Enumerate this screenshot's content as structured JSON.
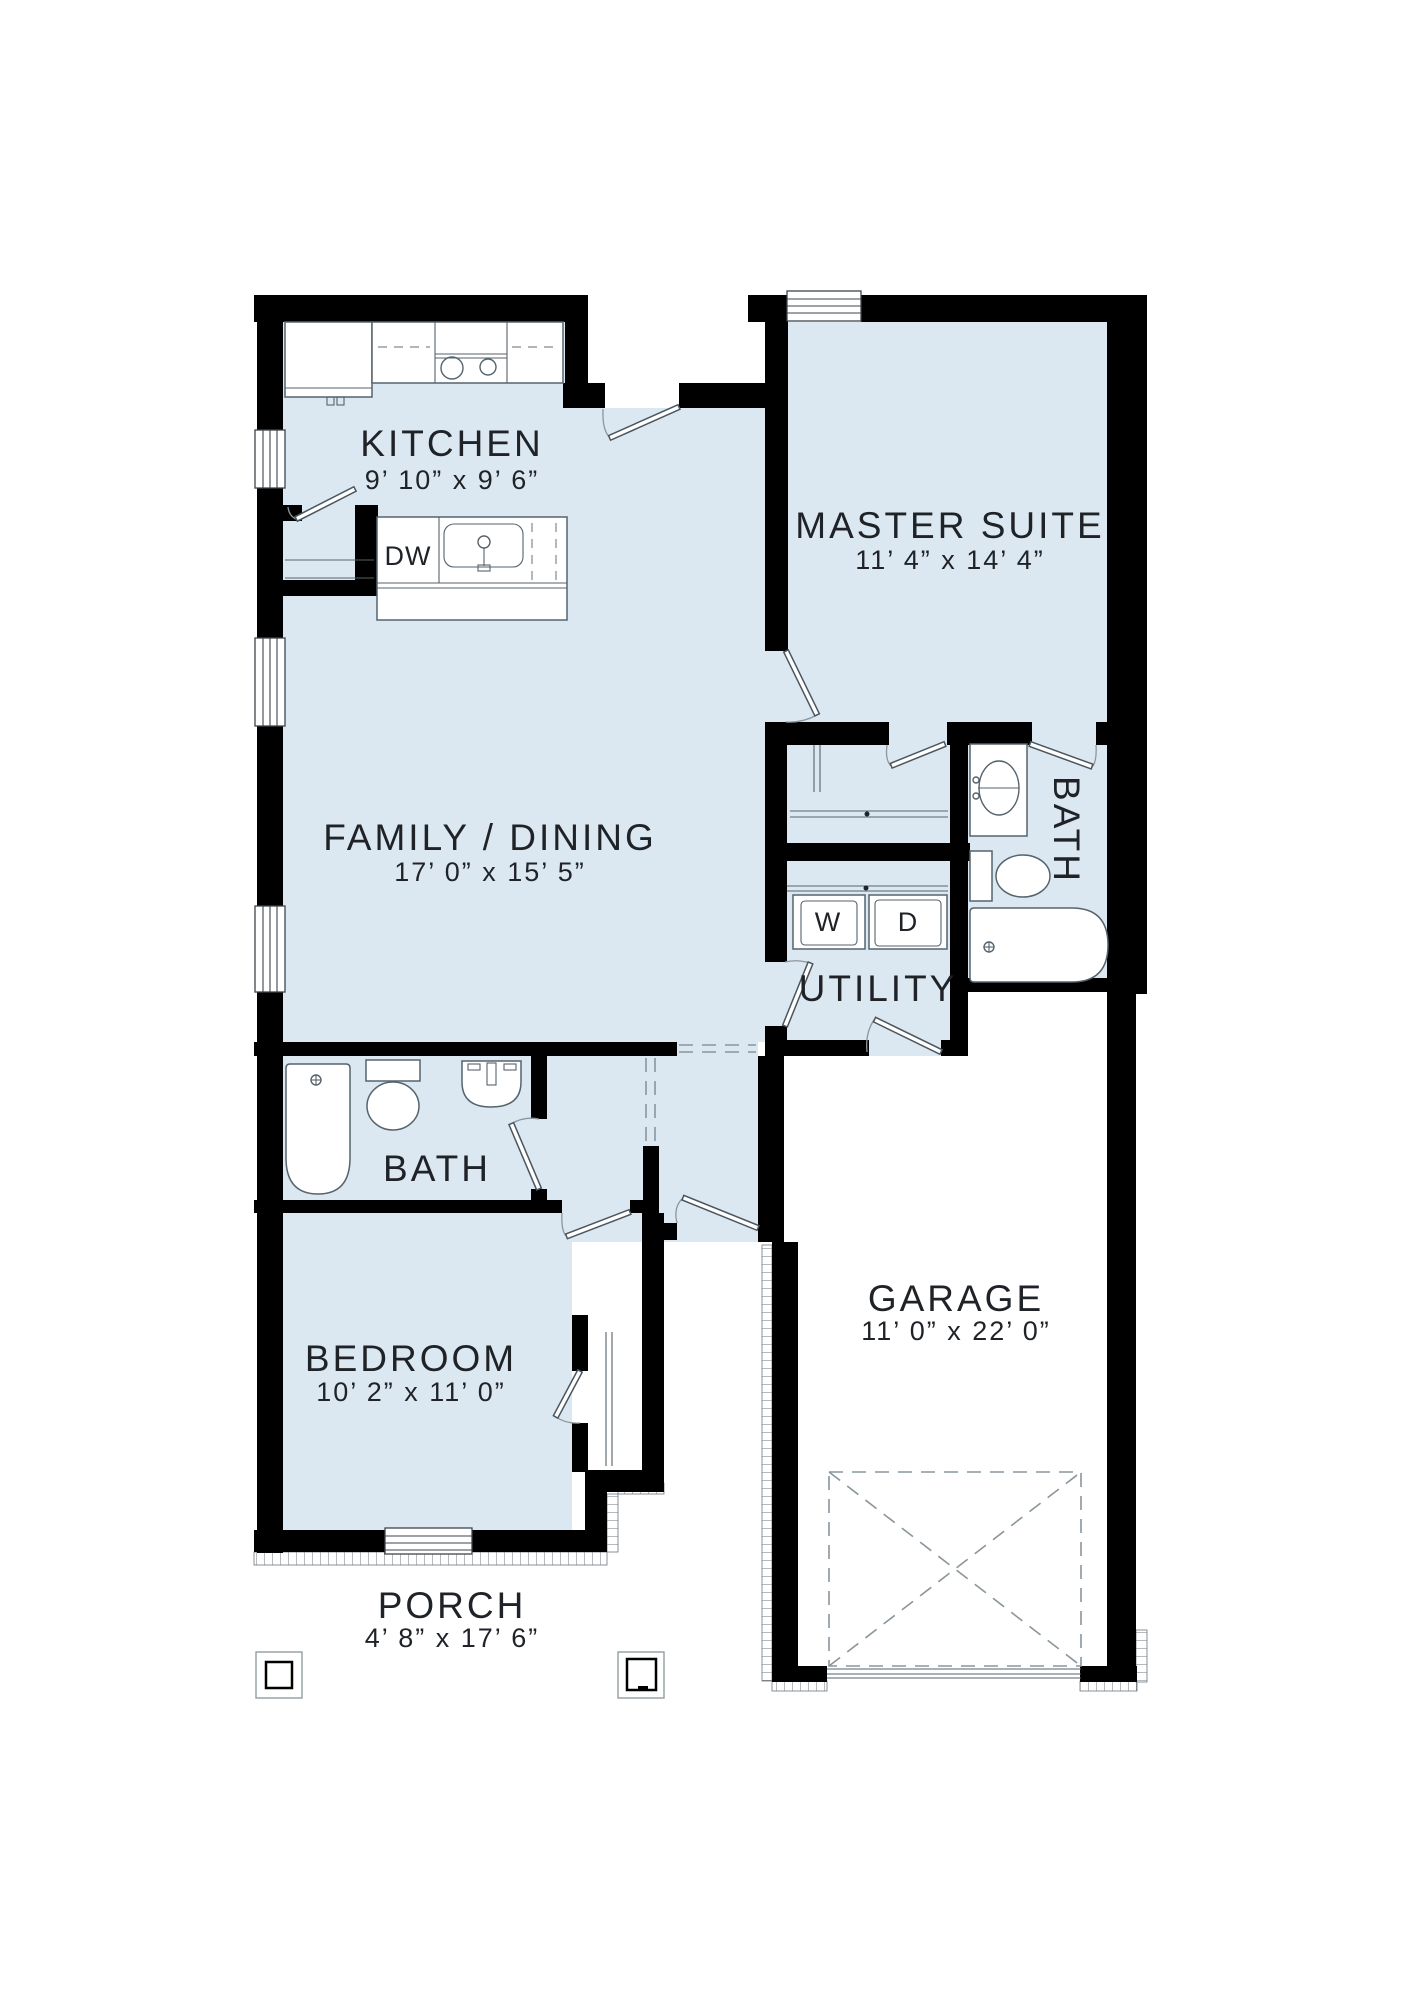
{
  "plan": {
    "rooms": {
      "kitchen": {
        "name": "KITCHEN",
        "dims": "9’ 10” x 9’ 6”"
      },
      "master_suite": {
        "name": "MASTER SUITE",
        "dims": "11’ 4” x 14’ 4”"
      },
      "family_dining": {
        "name": "FAMILY / DINING",
        "dims": "17’ 0” x 15’ 5”"
      },
      "master_bath": {
        "name": "BATH"
      },
      "utility": {
        "name": "UTILITY"
      },
      "bath": {
        "name": "BATH"
      },
      "bedroom": {
        "name": "BEDROOM",
        "dims": "10’ 2” x 11’ 0”"
      },
      "garage": {
        "name": "GARAGE",
        "dims": "11’ 0” x 22’ 0”"
      },
      "porch": {
        "name": "PORCH",
        "dims": "4’ 8” x 17’ 6”"
      }
    },
    "appliances": {
      "dishwasher": "DW",
      "washer": "W",
      "dryer": "D"
    },
    "colors": {
      "room_fill": "#dce8f1",
      "wall": "#000000",
      "fixture_line": "#55636d",
      "text": "#1f2328"
    }
  }
}
